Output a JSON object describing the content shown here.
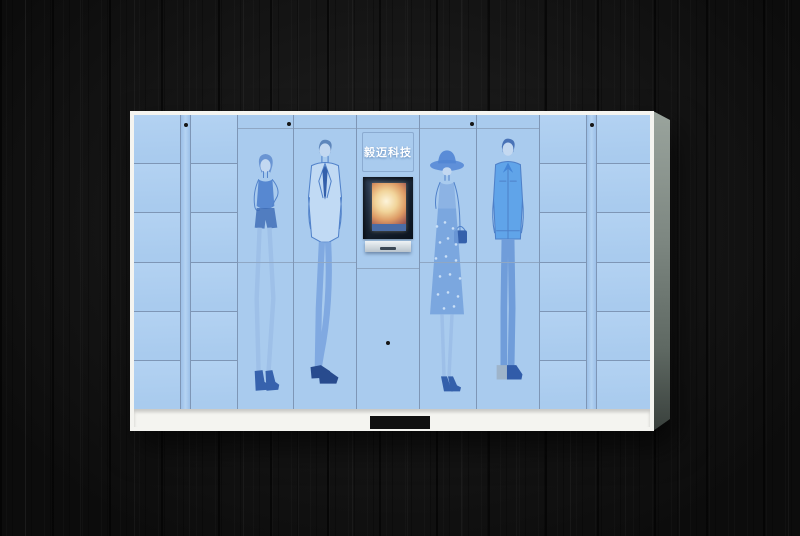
{
  "theme": {
    "wood": "#131313",
    "locker-blue": "#a9cbee",
    "locker-blue-light": "#b3d2f2",
    "seam": "#7e96b6",
    "seam-light": "#8fa7c4",
    "frame-white": "#f4f4f0",
    "side-gray": "#8b958f",
    "screen-dark": "#15202e",
    "sk": "#4a7cc7"
  },
  "locker": {
    "brand_label": "毅迈科技",
    "small_column_rows": 6,
    "figures": [
      "woman-tank-top",
      "man-suit",
      "woman-sun-hat",
      "man-denim-jacket"
    ]
  }
}
